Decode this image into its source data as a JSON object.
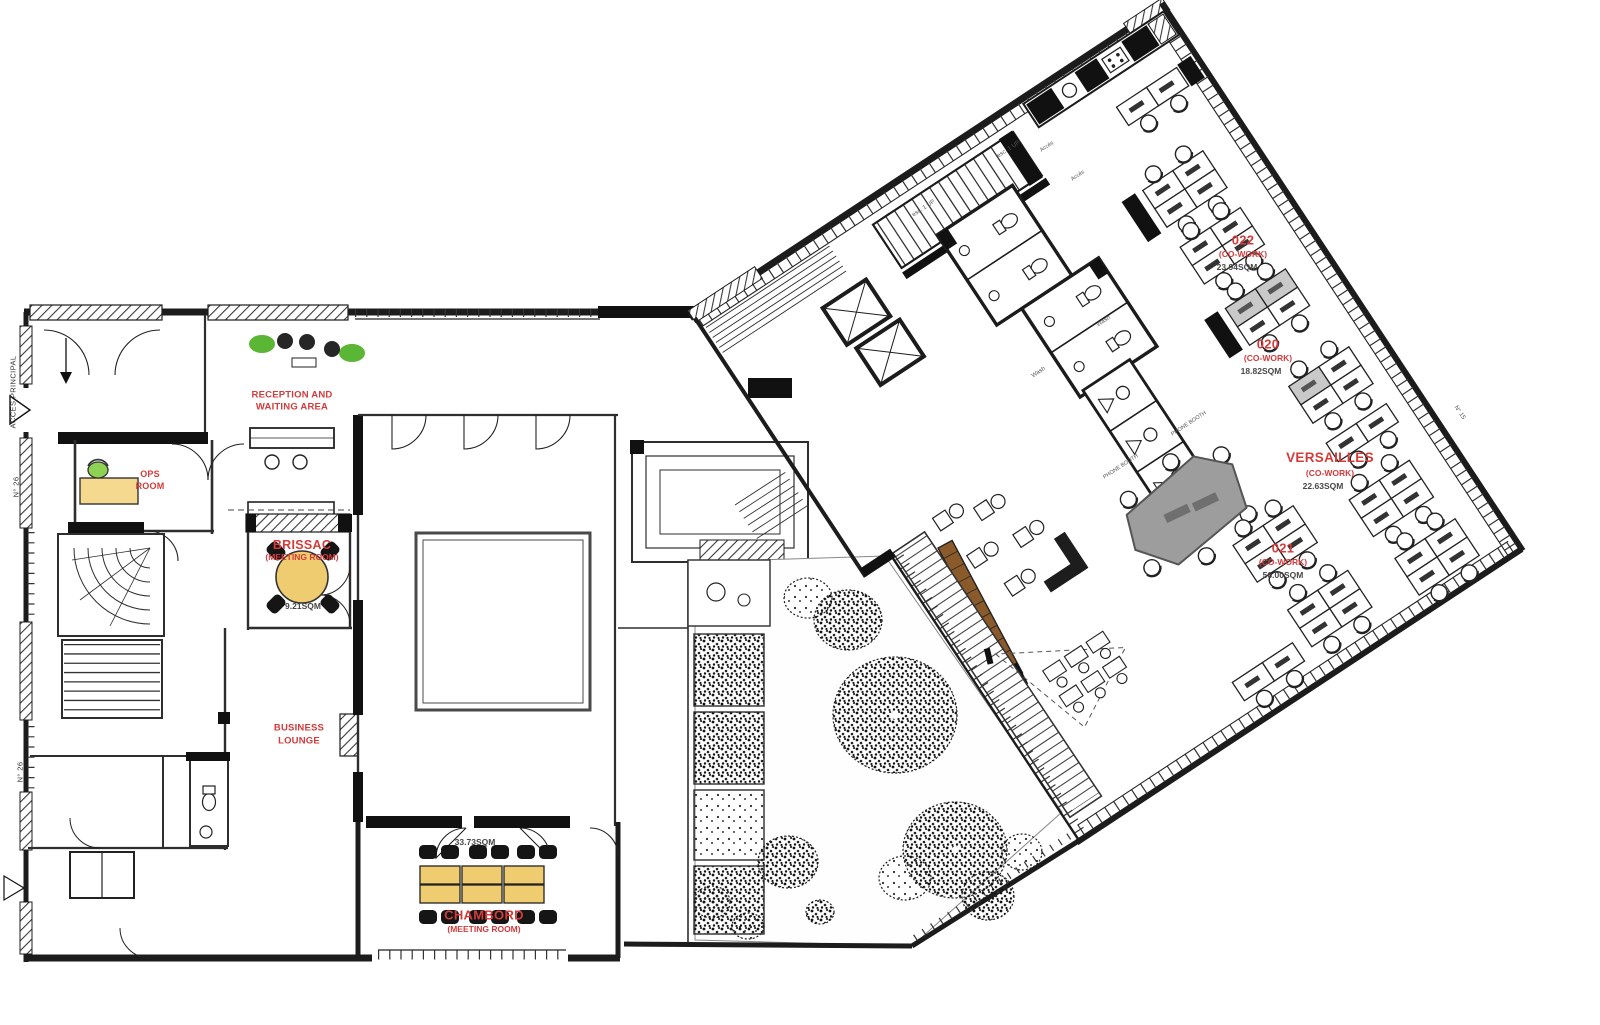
{
  "document": {
    "type": "architectural-floor-plan",
    "background": "#ffffff"
  },
  "colors": {
    "label_red": "#d43b3b",
    "area_text": "#474747",
    "wall": "#1c1c1c",
    "table_yellow": "#f0cc70",
    "desk_tan": "#f5d98f",
    "chair_green": "#8ed253",
    "plant_green": "#5cb636",
    "table_gray": "#9d9d9d"
  },
  "rooms": {
    "reception": {
      "label_line1": "RECEPTION AND",
      "label_line2": "WAITING AREA"
    },
    "ops": {
      "label_line1": "OPS",
      "label_line2": "ROOM"
    },
    "brissac": {
      "name": "BRISSAC",
      "type": "(MEETING ROOM)",
      "area": "9.21SQM"
    },
    "business_lounge": {
      "label_line1": "BUSINESS",
      "label_line2": "LOUNGE"
    },
    "chambord": {
      "name": "CHAMBORD",
      "type": "(MEETING ROOM)",
      "area": "33.73SQM"
    },
    "cowork_022": {
      "name": "022",
      "type": "(CO-WORK)",
      "area": "23.94SQM"
    },
    "cowork_020": {
      "name": "020",
      "type": "(CO-WORK)",
      "area": "18.82SQM"
    },
    "versailles": {
      "name": "VERSAILLES",
      "type": "(CO-WORK)",
      "area": "22.63SQM"
    },
    "cowork_021": {
      "name": "021",
      "type": "(CO-WORK)",
      "area": "56.00SQM"
    }
  },
  "annotations": {
    "acces_principal": "ACCES PRINCIPAL",
    "street_no_26": "N° 26",
    "street_no_15": "N° 15",
    "stair_up": "esc. 1 UP",
    "phone_booth": "PHONE BOOTH",
    "wash": "Wash",
    "acces": "Accès"
  }
}
